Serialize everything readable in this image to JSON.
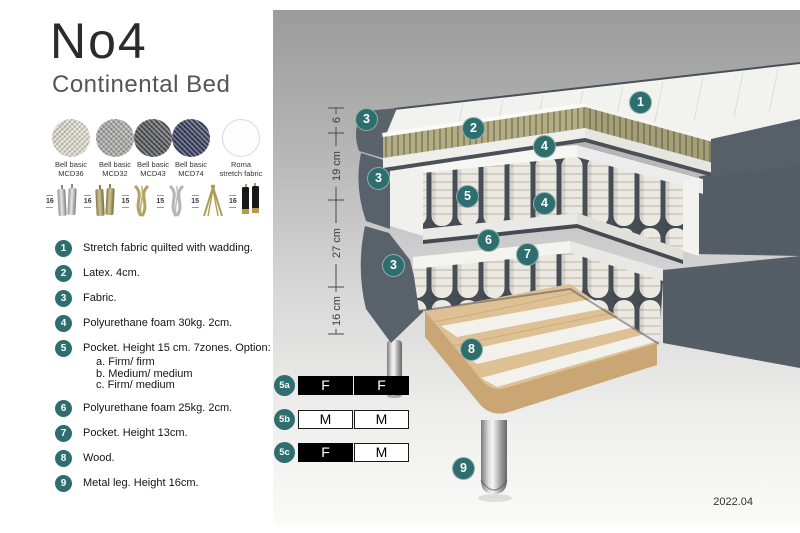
{
  "header": {
    "title": "No4",
    "subtitle": "Continental Bed"
  },
  "colors": {
    "accent": "#2e6e6e",
    "slate_fabric": "#59616a",
    "latex": "#b2ad84",
    "wood": "#ddc093",
    "spring": "#ebe9e2",
    "panel_top": "#9b9b9b"
  },
  "swatches": [
    {
      "name": "Bell basic",
      "code": "MCD36",
      "color": "#dcd8cd"
    },
    {
      "name": "Bell basic",
      "code": "MCD32",
      "color": "#a8a8a6"
    },
    {
      "name": "Bell basic",
      "code": "MCD43",
      "color": "#55565a"
    },
    {
      "name": "Bell basic",
      "code": "MCD74",
      "color": "#3c415f"
    },
    {
      "name": "Roma",
      "code": "stretch fabric",
      "color": "#fdfdfd"
    }
  ],
  "legs": [
    {
      "height": "16",
      "type": "cylinder pair silver"
    },
    {
      "height": "16",
      "type": "cylinder pair brass"
    },
    {
      "height": "15",
      "type": "curved brass"
    },
    {
      "height": "15",
      "type": "curved silver"
    },
    {
      "height": "15",
      "type": "hairpin brass"
    },
    {
      "height": "16",
      "type": "black with brass tip"
    }
  ],
  "legend": [
    {
      "num": "1",
      "text": "Stretch fabric quilted with wadding."
    },
    {
      "num": "2",
      "text": "Latex. 4cm."
    },
    {
      "num": "3",
      "text": "Fabric."
    },
    {
      "num": "4",
      "text": "Polyurethane foam 30kg. 2cm."
    },
    {
      "num": "5",
      "text": "Pocket. Height 15 cm. 7zones. Option:",
      "options": [
        "a. Firm/ firm",
        "b. Medium/ medium",
        "c. Firm/ medium"
      ]
    },
    {
      "num": "6",
      "text": "Polyurethane foam 25kg. 2cm."
    },
    {
      "num": "7",
      "text": "Pocket. Height 13cm."
    },
    {
      "num": "8",
      "text": "Wood."
    },
    {
      "num": "9",
      "text": "Metal leg. Height 16cm."
    }
  ],
  "diagram": {
    "dimensions": [
      {
        "label": "6"
      },
      {
        "label": "19 cm"
      },
      {
        "label": "27 cm"
      },
      {
        "label": "16 cm"
      }
    ],
    "callouts": [
      {
        "label": "1"
      },
      {
        "label": "2"
      },
      {
        "label": "3"
      },
      {
        "label": "3"
      },
      {
        "label": "3"
      },
      {
        "label": "4"
      },
      {
        "label": "4"
      },
      {
        "label": "5"
      },
      {
        "label": "6"
      },
      {
        "label": "7"
      },
      {
        "label": "8"
      },
      {
        "label": "9"
      }
    ],
    "firmness": [
      {
        "id": "5a",
        "cells": [
          {
            "letter": "F",
            "variant": "dark"
          },
          {
            "letter": "F",
            "variant": "dark"
          }
        ]
      },
      {
        "id": "5b",
        "cells": [
          {
            "letter": "M",
            "variant": "light"
          },
          {
            "letter": "M",
            "variant": "light"
          }
        ]
      },
      {
        "id": "5c",
        "cells": [
          {
            "letter": "F",
            "variant": "dark"
          },
          {
            "letter": "M",
            "variant": "light"
          }
        ]
      }
    ],
    "version": "2022.04"
  }
}
